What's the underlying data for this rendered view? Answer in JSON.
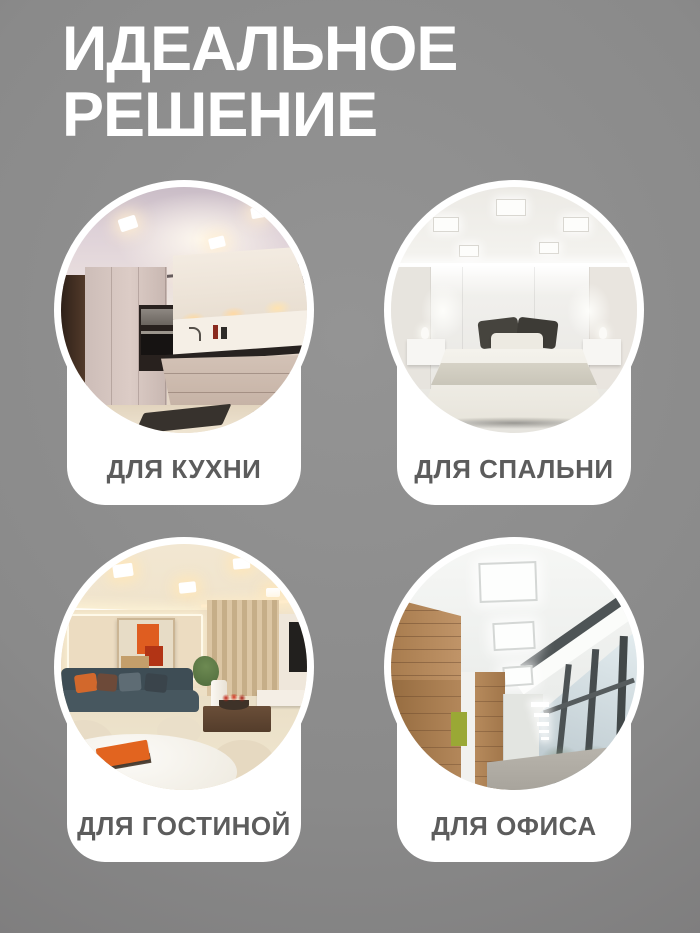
{
  "title": {
    "line1": "ИДЕАЛЬНОЕ",
    "line2": "РЕШЕНИЕ"
  },
  "cards": [
    {
      "id": "kitchen",
      "label": "ДЛЯ КУХНИ"
    },
    {
      "id": "bedroom",
      "label": "ДЛЯ СПАЛЬНИ"
    },
    {
      "id": "living-room",
      "label": "ДЛЯ ГОСТИНОЙ"
    },
    {
      "id": "office",
      "label": "ДЛЯ ОФИСА"
    }
  ],
  "colors": {
    "bg_center": "#949494",
    "bg_edge": "#706e6f",
    "card_bg": "#ffffff",
    "label_text": "#5c5c5c",
    "title_text": "#ffffff"
  }
}
